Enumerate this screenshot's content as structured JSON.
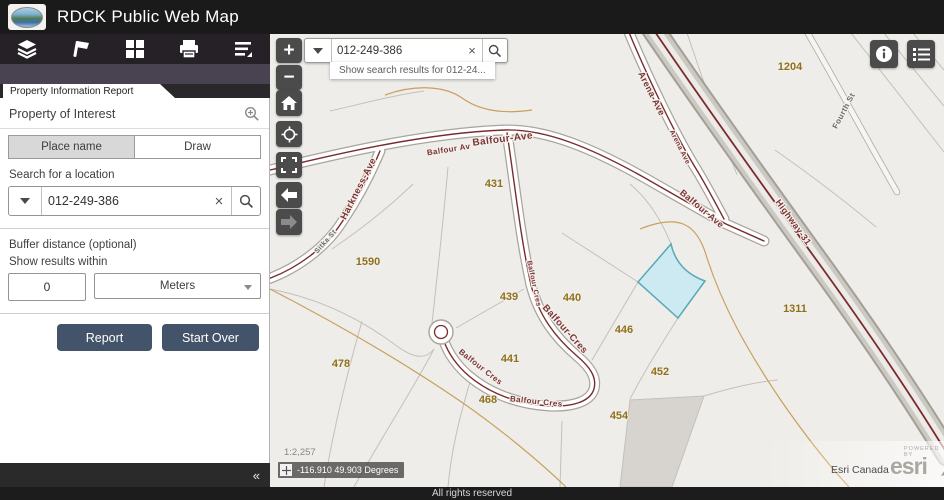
{
  "header": {
    "title": "RDCK Public Web Map"
  },
  "toolbar": {
    "items": [
      "layers",
      "draw",
      "basemap",
      "print",
      "legend"
    ]
  },
  "icons": {
    "collapse": "«",
    "zoom_in": "+",
    "zoom_out": "−",
    "clear": "×"
  },
  "panel": {
    "tab_title": "Property Information Report",
    "section_title": "Property of Interest",
    "tabs": [
      {
        "label": "Place name",
        "active": true
      },
      {
        "label": "Draw",
        "active": false
      }
    ],
    "search_label": "Search for a location",
    "search_value": "012-249-386",
    "buffer_label": "Buffer distance (optional)",
    "results_label": "Show results within",
    "buffer_value": "0",
    "unit_value": "Meters",
    "report_button": "Report",
    "start_over_button": "Start Over"
  },
  "map": {
    "search_value": "012-249-386",
    "suggestion": "Show search results for 012-24...",
    "scale": "1:2,257",
    "coordinates": "-116.910 49.903 Degrees",
    "attribution": "Esri Canada",
    "logo_text": "esri",
    "logo_super": "POWERED BY",
    "colors": {
      "land": "#efede9",
      "parcel_line": "#c4c0b9",
      "gray_parcel": "#d7d4d0",
      "contour": "#c9a05c",
      "road_casing": "#a9a49e",
      "road_fill": "#ffffff",
      "road_center": "#7a2c2c",
      "highlight_fill": "#cdeaf2",
      "highlight_stroke": "#57a8b5",
      "street_label": "#7d3434",
      "street_label_gray": "#6e6a64",
      "parcel_label": "#8f701c",
      "halo": "#f2f0ec"
    },
    "highlight_parcel": {
      "d": "M 671,244 Q 677,271 705,281 L 678,318 L 638,282 Z"
    },
    "gray_parcels": [
      "M 630,400 L 704,396 L 672,487 L 620,487 Z"
    ],
    "roads": [
      {
        "name": "balfour-ave",
        "type": "road",
        "d": "M 270,170 C 320,158 420,133 505,130 C 545,129 590,147 645,178 C 680,198 706,213 726,224 L 764,241"
      },
      {
        "name": "harkness-ave",
        "type": "road",
        "d": "M 380,151 C 370,175 356,201 342,222 C 326,247 298,268 268,279"
      },
      {
        "name": "arena-ave",
        "type": "road",
        "d": "M 628,30 C 648,78 675,135 698,172 C 707,187 716,204 724,219"
      },
      {
        "name": "balfour-cres",
        "type": "road",
        "d": "M 507,133 C 515,185 520,235 531,285 C 539,316 555,337 577,356 C 590,367 597,377 594,389 C 590,402 572,407 549,406 C 517,404 489,393 469,376 C 457,366 448,353 444,341"
      },
      {
        "name": "fourth-st",
        "type": "minor",
        "d": "M 806,30 C 836,82 866,138 897,192"
      },
      {
        "name": "highway-31",
        "type": "highway",
        "d": "M 651,26 C 700,98 755,175 815,258 C 860,320 905,385 948,455"
      }
    ],
    "culdesac": {
      "cx": 441,
      "cy": 332,
      "r": 12
    },
    "parcel_lines": [
      "M 448,167 C 442,235 436,287 431,332",
      "M 413,184 C 384,212 354,234 332,249",
      "M 270,289 C 312,297 355,315 394,344 C 410,356 424,362 434,349",
      "M 362,321 C 347,374 333,430 324,487",
      "M 434,349 C 412,391 380,440 354,487",
      "M 470,382 C 459,419 451,452 448,487",
      "M 524,289 L 456,328",
      "M 592,360 L 638,282",
      "M 638,282 L 562,233",
      "M 671,244 C 662,222 650,201 630,184",
      "M 678,318 C 662,343 645,370 630,399",
      "M 562,421 L 560,487",
      "M 704,396 C 730,388 755,382 778,380",
      "M 687,33 C 703,80 720,130 737,175",
      "M 775,150 C 812,176 845,201 876,227",
      "M 851,33 L 944,152",
      "M 884,33 L 944,106",
      "M 913,33 L 944,70",
      "M 330,111 C 365,103 395,95 424,91"
    ],
    "contours": [
      "M 385,95 C 415,84 445,86 462,98 C 480,111 505,114 532,110",
      "M 270,289 C 330,320 400,360 460,401 C 502,430 540,462 566,487",
      "M 640,229 C 678,214 697,222 707,258 C 722,304 745,347 780,399 C 802,431 826,462 849,487"
    ],
    "street_labels": [
      {
        "text": "Balfour-Ave",
        "x": 503,
        "y": 142,
        "rot": -7,
        "size": 10
      },
      {
        "text": "Balfour Av",
        "x": 449,
        "y": 152,
        "rot": -9,
        "size": 8
      },
      {
        "text": "Harkness-Ave",
        "x": 361,
        "y": 190,
        "rot": -63,
        "size": 9.5
      },
      {
        "text": "Sitka St",
        "x": 327,
        "y": 243,
        "rot": -48,
        "size": 7,
        "gray": true
      },
      {
        "text": "Arena-Ave",
        "x": 649,
        "y": 95,
        "rot": 63,
        "size": 9
      },
      {
        "text": "Arena Ave",
        "x": 678,
        "y": 148,
        "rot": 63,
        "size": 7
      },
      {
        "text": "Balfour Ave",
        "x": 700,
        "y": 211,
        "rot": 40,
        "size": 9
      },
      {
        "text": "Highway-31",
        "x": 791,
        "y": 224,
        "rot": 54,
        "size": 9
      },
      {
        "text": "Fourth St",
        "x": 846,
        "y": 112,
        "rot": -62,
        "size": 8,
        "gray": true
      },
      {
        "text": "Balfour-Cres",
        "x": 563,
        "y": 331,
        "rot": 48,
        "size": 9.5
      },
      {
        "text": "Balfour Cres",
        "x": 536,
        "y": 404,
        "rot": 6,
        "size": 8
      },
      {
        "text": "Balfour Cres",
        "x": 479,
        "y": 369,
        "rot": 38,
        "size": 8
      },
      {
        "text": "Balfour Cres",
        "x": 532,
        "y": 284,
        "rot": 78,
        "size": 7
      }
    ],
    "parcel_labels": [
      {
        "text": "1204",
        "x": 790,
        "y": 70
      },
      {
        "text": "431",
        "x": 494,
        "y": 187
      },
      {
        "text": "1590",
        "x": 368,
        "y": 265
      },
      {
        "text": "439",
        "x": 509,
        "y": 300
      },
      {
        "text": "440",
        "x": 572,
        "y": 301
      },
      {
        "text": "446",
        "x": 624,
        "y": 333
      },
      {
        "text": "441",
        "x": 510,
        "y": 362
      },
      {
        "text": "452",
        "x": 660,
        "y": 375
      },
      {
        "text": "478",
        "x": 341,
        "y": 367
      },
      {
        "text": "468",
        "x": 488,
        "y": 403
      },
      {
        "text": "454",
        "x": 619,
        "y": 419
      },
      {
        "text": "1311",
        "x": 795,
        "y": 312
      }
    ]
  },
  "footer": {
    "text": "All rights reserved"
  }
}
